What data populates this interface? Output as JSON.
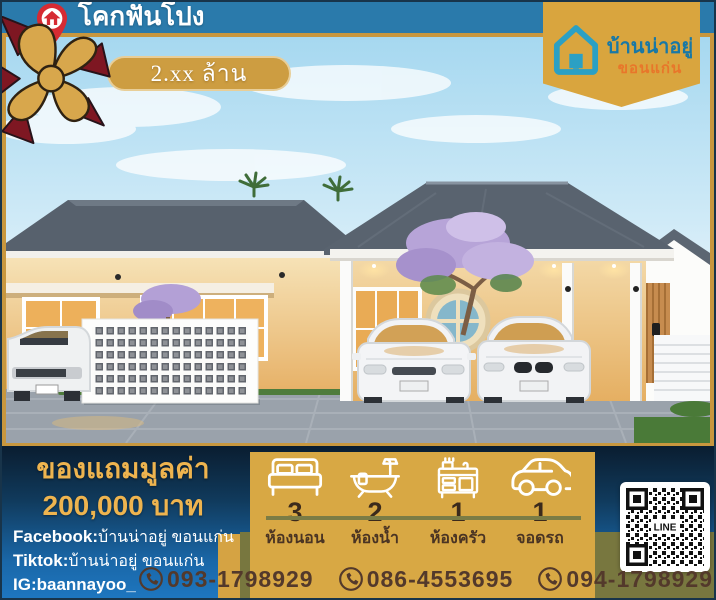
{
  "colors": {
    "bar_teal": "#2a7aab",
    "frame_gold": "#c8973e",
    "panel_gold": "#d8a844",
    "badge_gold": "#d9a53e",
    "ribbon_red": "#7e1722",
    "band_navy_top": "#0a1d30",
    "band_blue_bottom": "#1e77c0",
    "olive_green": "#78773f",
    "phone_brown": "#53392b",
    "promo_gold": "#eeb44f",
    "brand_teal": "#1878a6",
    "brand_orange": "#e8762a"
  },
  "header": {
    "location_title": "โคกฟันโปง",
    "price_label": "2.xx ล้าน"
  },
  "brand": {
    "name": "บ้านน่าอยู่",
    "city": "ขอนแก่น"
  },
  "promo": {
    "line1": "ของแถมมูลค่า",
    "line2": "200,000 บาท"
  },
  "socials": [
    {
      "label": "Facebook:",
      "value": "บ้านน่าอยู่ ขอนแก่น"
    },
    {
      "label": "Tiktok:",
      "value": "บ้านน่าอยู่ ขอนแก่น"
    },
    {
      "label": "IG:",
      "value": "baannayoo_"
    }
  ],
  "features": [
    {
      "icon": "bed-icon",
      "count": "3",
      "label": "ห้องนอน"
    },
    {
      "icon": "bathtub-icon",
      "count": "2",
      "label": "ห้องน้ำ"
    },
    {
      "icon": "kitchen-icon",
      "count": "1",
      "label": "ห้องครัว"
    },
    {
      "icon": "car-icon",
      "count": "1",
      "label": "จอดรถ"
    }
  ],
  "phones": [
    "093-1798929",
    "086-4553695",
    "094-1798929"
  ],
  "qr": {
    "label": "LINE"
  }
}
